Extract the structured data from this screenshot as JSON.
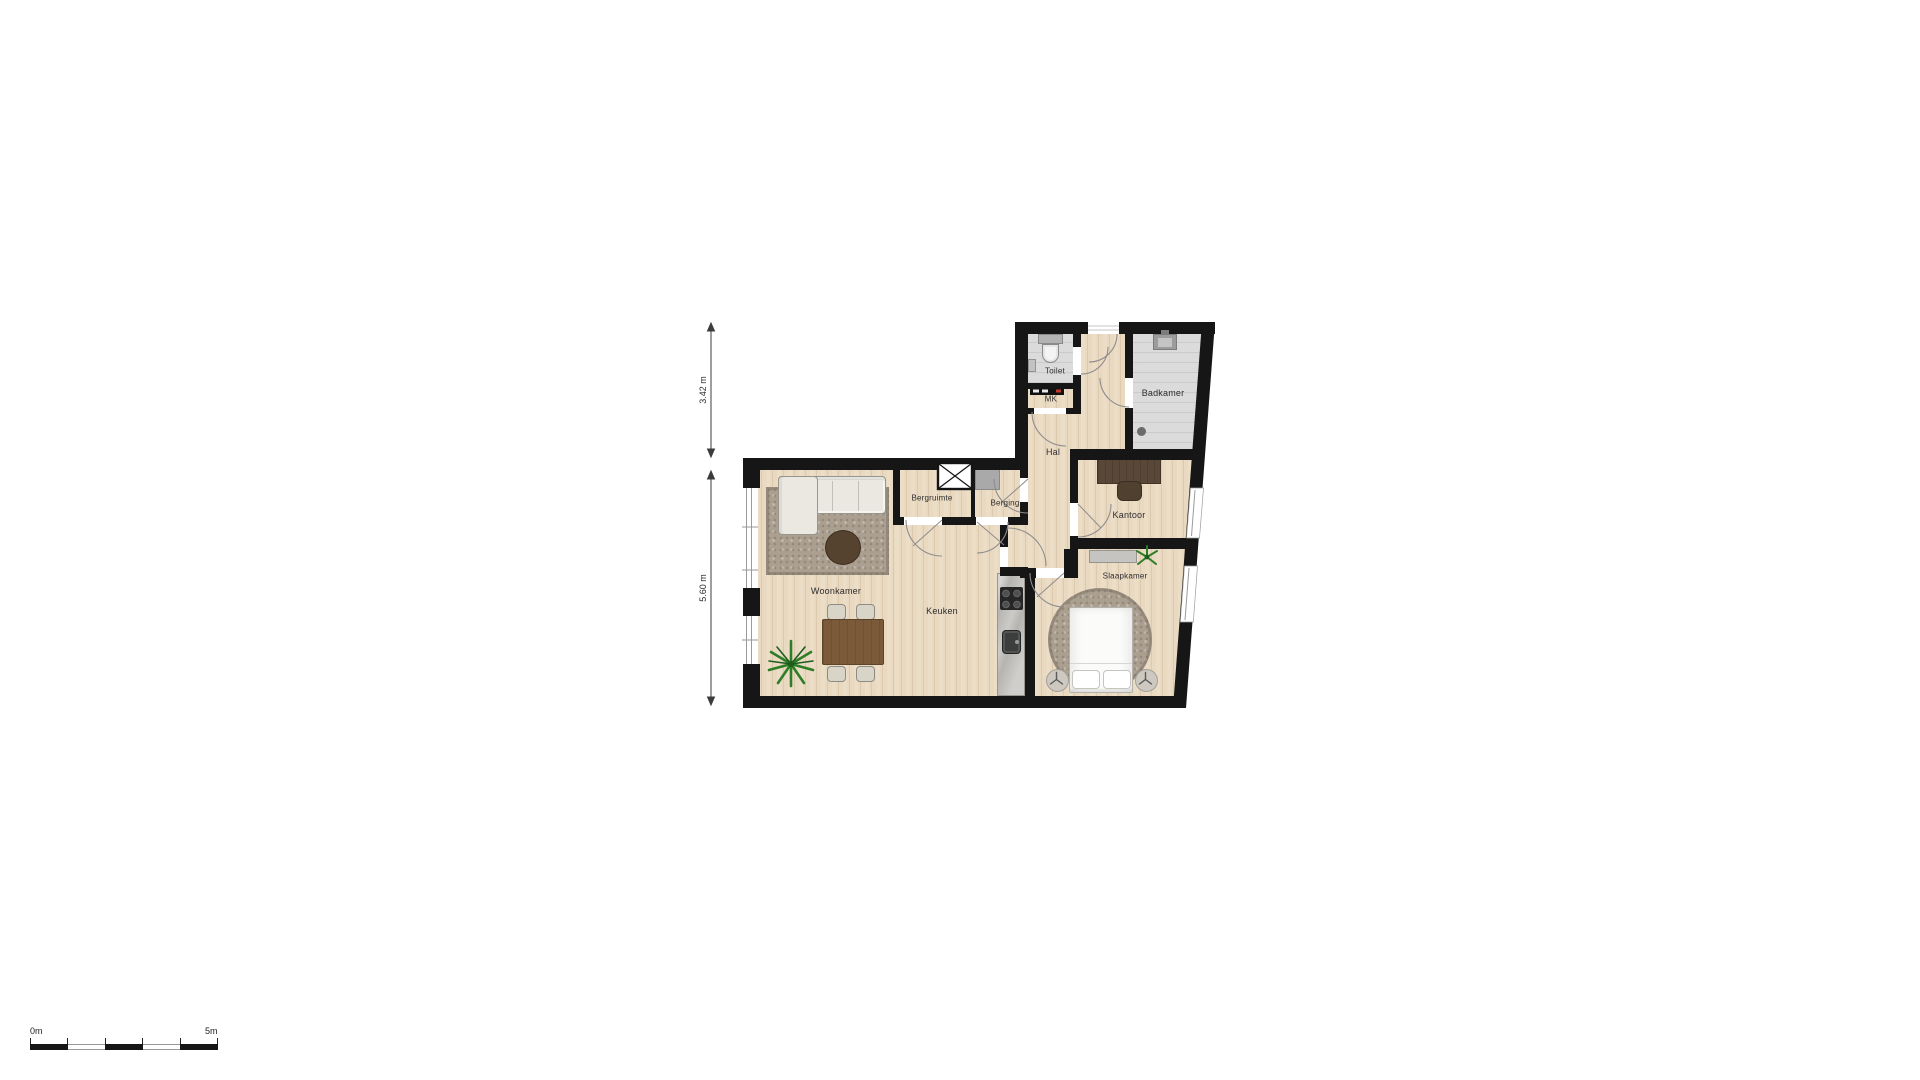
{
  "floorplan": {
    "rooms": [
      {
        "key": "toilet",
        "label": "Toilet"
      },
      {
        "key": "mk",
        "label": "MK"
      },
      {
        "key": "hal",
        "label": "Hal"
      },
      {
        "key": "badkamer",
        "label": "Badkamer"
      },
      {
        "key": "bergruimte",
        "label": "Bergruimte"
      },
      {
        "key": "berging",
        "label": "Berging"
      },
      {
        "key": "kantoor",
        "label": "Kantoor"
      },
      {
        "key": "woonkamer",
        "label": "Woonkamer"
      },
      {
        "key": "keuken",
        "label": "Keuken"
      },
      {
        "key": "slaapkamer",
        "label": "Slaapkamer"
      }
    ],
    "dimensions": [
      {
        "label": "3.42 m"
      },
      {
        "label": "5.60 m"
      }
    ],
    "scale_bar": {
      "start": "0m",
      "end": "5m"
    },
    "icons": [
      "sofa",
      "coffee-table",
      "dining-table",
      "chair",
      "plant-icon",
      "kitchen-counter",
      "stove-icon",
      "sink-icon",
      "bed",
      "pillow",
      "nightstand",
      "lamp-icon",
      "wardrobe",
      "desk",
      "desk-chair",
      "toilet-icon",
      "washbasin-icon",
      "shower-icon",
      "drain-icon",
      "meter-panel-icon",
      "shaft-x-icon",
      "appliance",
      "door-arc",
      "window"
    ],
    "colors": {
      "wall": "#161616",
      "wood_floor": "#ead9c1",
      "tile_floor": "#d4d4d4",
      "rug": "#ab9f90",
      "sofa": "#eae8e1",
      "table_wood": "#7b5a3a",
      "desk_wood": "#594738",
      "plant_green": "#2e7d27",
      "counter": "#b5b4b0"
    }
  }
}
